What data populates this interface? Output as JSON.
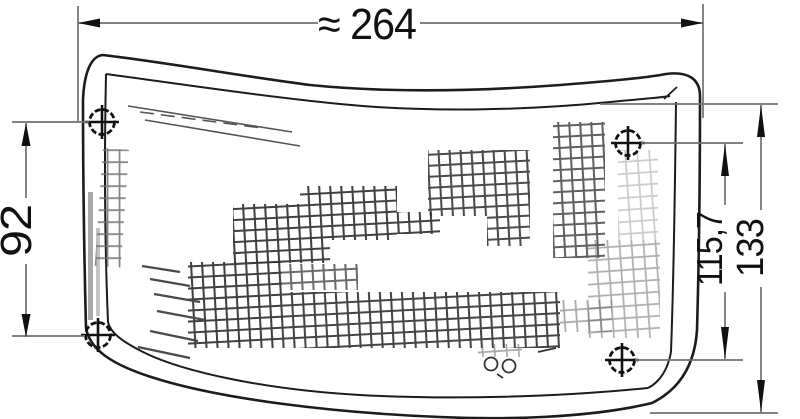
{
  "drawing": {
    "title": "wrap-around lamp lens technical drawing",
    "dimensions": {
      "width": {
        "label": "≈ 264"
      },
      "left_height": {
        "label": "92"
      },
      "right_inner_height": {
        "label": "115,7"
      },
      "right_outer_height": {
        "label": "133"
      }
    },
    "colors": {
      "outline": "#1c1c1c",
      "detail": "#555555",
      "dimension_lines": "#707070",
      "arrows_text": "#111111",
      "background": "#ffffff"
    }
  }
}
